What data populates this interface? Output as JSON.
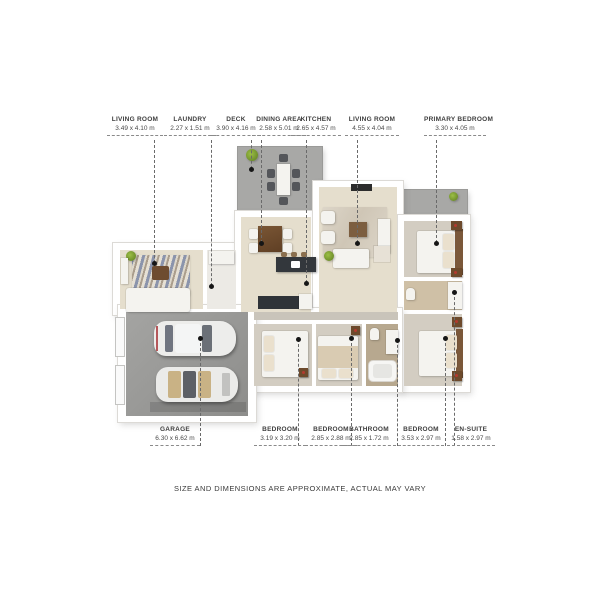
{
  "title": "3D floor plan render",
  "disclaimer": "SIZE AND DIMENSIONS ARE APPROXIMATE, ACTUAL MAY VARY",
  "labels": {
    "top": [
      {
        "name": "LIVING ROOM",
        "dims": "3.49 x 4.10 m"
      },
      {
        "name": "LAUNDRY",
        "dims": "2.27 x 1.51 m"
      },
      {
        "name": "DECK",
        "dims": "3.90 x 4.16 m"
      },
      {
        "name": "DINING AREA",
        "dims": "2.58 x 5.01 m"
      },
      {
        "name": "KITCHEN",
        "dims": "2.65 x 4.57 m"
      },
      {
        "name": "LIVING ROOM",
        "dims": "4.55 x 4.04 m"
      },
      {
        "name": "PRIMARY BEDROOM",
        "dims": "3.30 x 4.05 m"
      }
    ],
    "bottom": [
      {
        "name": "GARAGE",
        "dims": "6.30 x 6.62 m"
      },
      {
        "name": "BEDROOM",
        "dims": "3.19 x 3.20 m"
      },
      {
        "name": "BEDROOM",
        "dims": "2.85 x 2.88 m"
      },
      {
        "name": "BATHROOM",
        "dims": "2.85 x 1.72 m"
      },
      {
        "name": "BEDROOM",
        "dims": "3.53 x 2.97 m"
      },
      {
        "name": "EN-SUITE",
        "dims": "1.58 x 2.97 m"
      }
    ]
  },
  "palette": {
    "page": "#ffffff",
    "wall": "#ffffff",
    "deck": "#a8a8a6",
    "garage": "#9a9a98",
    "floorMain": "#e5decd",
    "floorBedroom": "#d3cdc2",
    "floorBath": "#b7a88f",
    "floorEnsuite": "#cfc0a6",
    "wood": "#6e4c30",
    "dark": "#33373c",
    "plant": "#6f8f2b",
    "line": "#6a6a6a",
    "text": "#3d3d3d"
  }
}
